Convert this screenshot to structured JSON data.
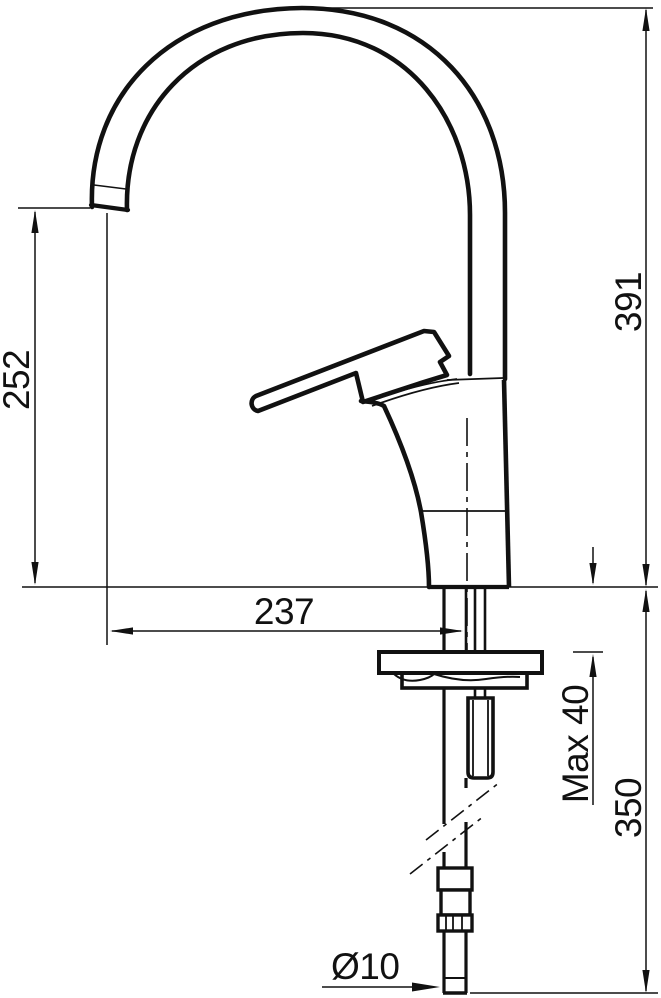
{
  "drawing": {
    "colors": {
      "line": "#111111",
      "background": "#ffffff"
    },
    "dimensions": {
      "spout_height": "252",
      "overall_height": "391",
      "spout_reach": "237",
      "max_mounting_thickness": "Max 40",
      "tail_length": "350",
      "tail_diameter": "Ø10"
    }
  }
}
